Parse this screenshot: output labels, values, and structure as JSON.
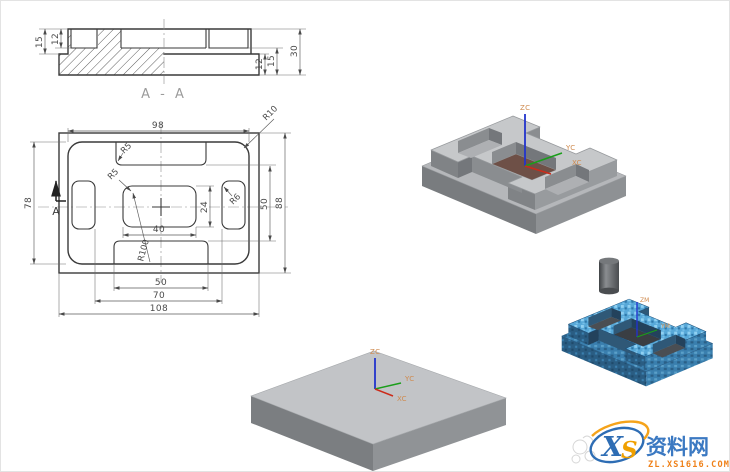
{
  "page": {
    "background": "#ffffff"
  },
  "section_view": {
    "label": "A - A",
    "dims": {
      "left_outer": "15",
      "left_inner": "12",
      "right_inner": "12",
      "right_mid": "15",
      "right_outer": "30"
    }
  },
  "plan_view": {
    "dims": {
      "top_width": "98",
      "left_height": "78",
      "right_inner": "50",
      "right_outer": "88",
      "pocket_height": "24",
      "pocket_width": "40",
      "bottom_slot": "50",
      "bottom_pockets": "70",
      "bottom_overall": "108"
    },
    "radii": {
      "corner": "R10",
      "top_slot": "R5",
      "center_pocket": "R5",
      "side_pocket": "R6",
      "bottom_arc": "R100"
    },
    "section_arrow": "A"
  },
  "iso_views": {
    "finished_part": {
      "axis_z": "ZC",
      "axis_y": "YC",
      "axis_x": "XC"
    },
    "simulation": {
      "axis_z": "ZM",
      "axis_y": "YM"
    },
    "stock_block": {
      "axis_z": "ZC",
      "axis_y": "YC",
      "axis_x": "XC"
    }
  },
  "watermark": {
    "logo_x": "X",
    "logo_s": "S",
    "site_name": "资料网",
    "site_url": "ZL.XS1616.COM"
  },
  "colors": {
    "drawing_line": "#3a3a3a",
    "dim_line": "#5a5a5a",
    "part_gray_top": "#c6c8ca",
    "part_gray_side": "#989b9e",
    "pocket_floor_brown": "#6e5047",
    "sim_blue": "#57a8d8",
    "axis_z_blue": "#2233cc",
    "axis_y_green": "#1a9e1a",
    "axis_x_red": "#cc2b1a",
    "axis_label_orange": "#cf8a4e",
    "watermark_blue": "#2e6db4",
    "watermark_orange": "#f08519"
  }
}
